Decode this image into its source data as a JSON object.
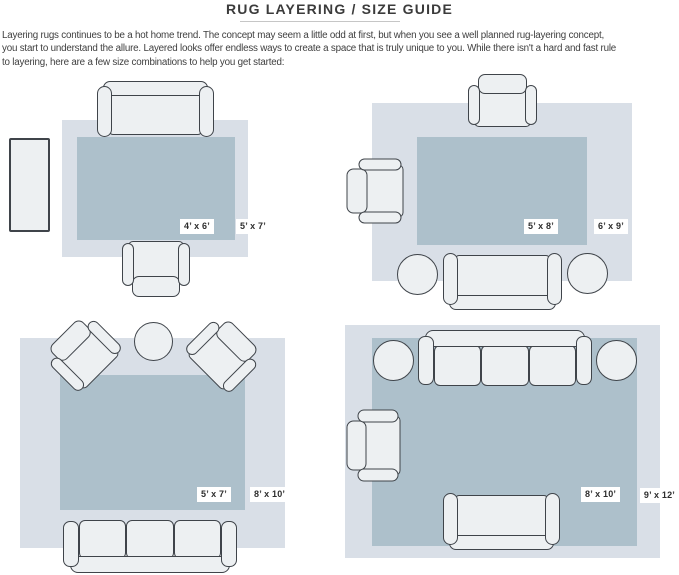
{
  "header": {
    "title": "RUG LAYERING / SIZE GUIDE",
    "intro_lines": [
      "Layering rugs continues to be a hot home trend. The concept may seem a little odd at first, but when you see a well planned rug-layering concept,",
      "you start to understand the allure. Layered looks offer endless ways to create a space that is truly unique to you. While there isn't a hard and fast rule",
      "to layering, here are a few size combinations to help you get started:"
    ]
  },
  "layouts": [
    {
      "position": "top-left",
      "top_rug_size": "4’ x 6’",
      "bottom_rug_size": "5’ x 7’"
    },
    {
      "position": "top-right",
      "top_rug_size": "5’ x 8’",
      "bottom_rug_size": "6’ x 9’"
    },
    {
      "position": "bottom-left",
      "top_rug_size": "5’ x 7’",
      "bottom_rug_size": "8’ x 10’"
    },
    {
      "position": "bottom-right",
      "top_rug_size": "8’ x 10’",
      "bottom_rug_size": "9’ x 12’"
    }
  ],
  "colors": {
    "rug_top": "#adc0cb",
    "rug_bottom": "#d9dfe7",
    "furniture_fill": "#edf0f2",
    "furniture_outline": "#3f444a",
    "label_bg": "#ffffff",
    "title": "#3b3b3b",
    "text": "#3e3e3e",
    "divider": "#c6c6c6"
  }
}
